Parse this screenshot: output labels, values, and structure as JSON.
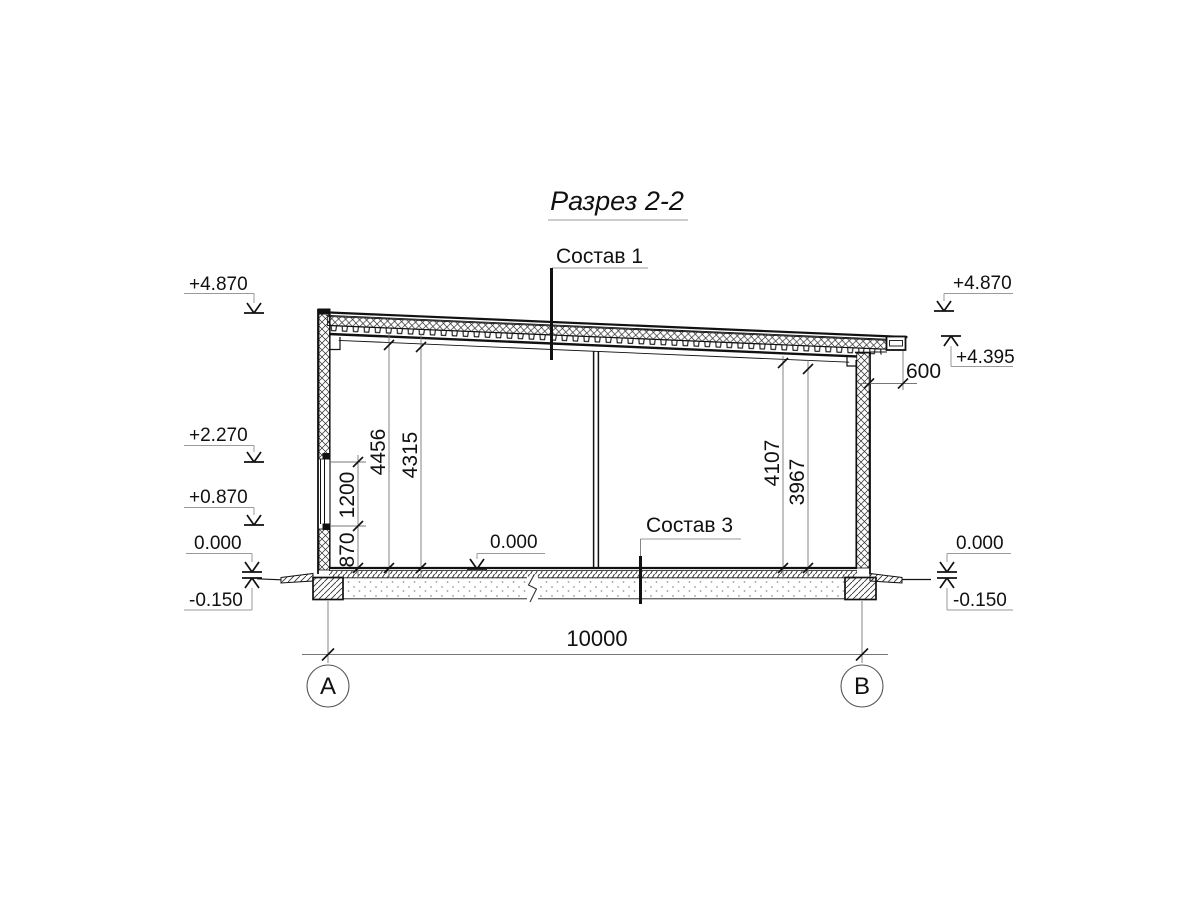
{
  "title": {
    "text": "Разрез 2-2"
  },
  "callouts": {
    "roof_composition": "Состав 1",
    "floor_composition": "Состав 3"
  },
  "elevations": {
    "left": {
      "roof_top": "+4.870",
      "window_head": "+2.270",
      "window_sill": "+0.870",
      "floor": "0.000",
      "ground": "-0.150"
    },
    "right": {
      "roof_top": "+4.870",
      "eave": "+4.395",
      "floor": "0.000",
      "ground": "-0.150"
    },
    "interior_floor": "0.000"
  },
  "dimensions": {
    "span": "10000",
    "roof_overhang": "600",
    "left_wall_chain": {
      "sill_height": "870",
      "window_height": "1200"
    },
    "interior_left": {
      "outer": "4456",
      "inner": "4315"
    },
    "interior_right": {
      "outer": "4107",
      "inner": "3967"
    }
  },
  "axes": {
    "left": "А",
    "right": "В"
  }
}
